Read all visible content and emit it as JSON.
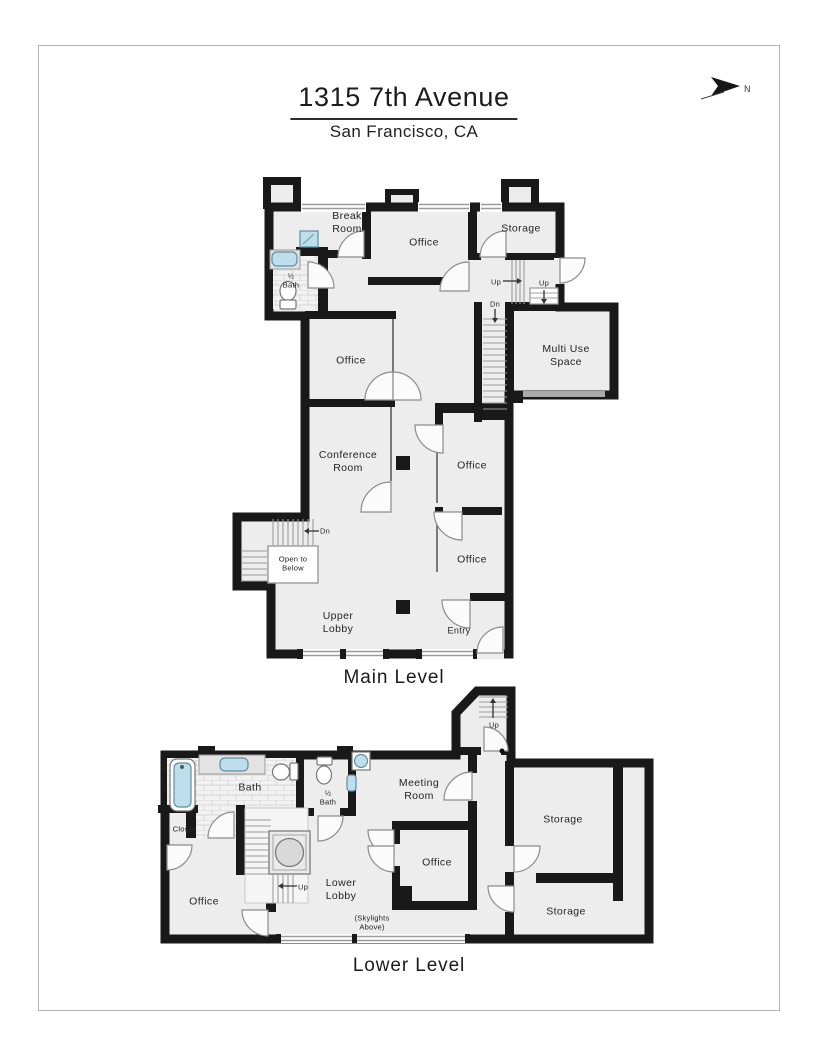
{
  "page": {
    "title": "1315 7th Avenue",
    "subtitle": "San Francisco, CA",
    "north_label": "N"
  },
  "palette": {
    "wall": "#191919",
    "floor": "#ededed",
    "fixture_blue": "#bfdeed",
    "door_stroke": "#8c8c8c",
    "window_gray": "#9a9a9a"
  },
  "icons": {
    "north_arrow": "north-arrow-icon",
    "bath_fixtures": [
      "sink",
      "toilet",
      "tub",
      "vanity-cabinet",
      "round-basin"
    ]
  },
  "main_level": {
    "caption": "Main Level",
    "rooms": [
      {
        "label": "Break\nRoom"
      },
      {
        "label": "Office"
      },
      {
        "label": "Storage"
      },
      {
        "label": "½\nBath"
      },
      {
        "label": "Office"
      },
      {
        "label": "Multi Use\nSpace"
      },
      {
        "label": "Conference\nRoom"
      },
      {
        "label": "Office"
      },
      {
        "label": "Office"
      },
      {
        "label": "Upper\nLobby"
      }
    ],
    "annotations": [
      {
        "label": "Entry"
      },
      {
        "label": "Open to\nBelow"
      }
    ],
    "stair_labels": [
      {
        "label": "Up"
      },
      {
        "label": "Up"
      },
      {
        "label": "Dn"
      },
      {
        "label": "Dn"
      }
    ]
  },
  "lower_level": {
    "caption": "Lower Level",
    "rooms": [
      {
        "label": "Bath"
      },
      {
        "label": "½\nBath"
      },
      {
        "label": "Closet"
      },
      {
        "label": "Meeting\nRoom"
      },
      {
        "label": "Office"
      },
      {
        "label": "Office"
      },
      {
        "label": "Lower\nLobby"
      },
      {
        "label": "Storage"
      },
      {
        "label": "Storage"
      }
    ],
    "annotations": [
      {
        "label": "(Skylights\nAbove)"
      }
    ],
    "stair_labels": [
      {
        "label": "Up"
      },
      {
        "label": "Up"
      }
    ]
  }
}
